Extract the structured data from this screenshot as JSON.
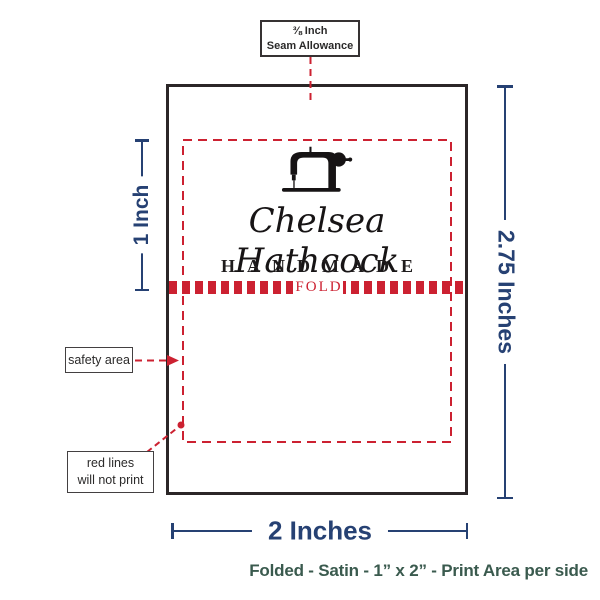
{
  "colors": {
    "guide_red": "#cc2131",
    "dimension_navy": "#264173",
    "ink": "#2b2a2a",
    "outline": "#2b2627",
    "caption_teal": "#3a5a4e"
  },
  "seam_note": {
    "line1": "⅜ Inch",
    "line2": "Seam Allowance"
  },
  "brand": {
    "name": "Chelsea Hathcock",
    "subtitle": "HANDMADE",
    "fold": "FOLD"
  },
  "annotations": {
    "safety": "safety area",
    "red_lines_line1": "red lines",
    "red_lines_line2": "will not print"
  },
  "measurements": {
    "fold_height": "1 Inch",
    "label_height": "2.75 Inches",
    "label_width": "2 Inches"
  },
  "caption": "Folded - Satin - 1” x 2” - Print Area per side",
  "icons": {
    "machine": "sewing-machine-icon"
  }
}
